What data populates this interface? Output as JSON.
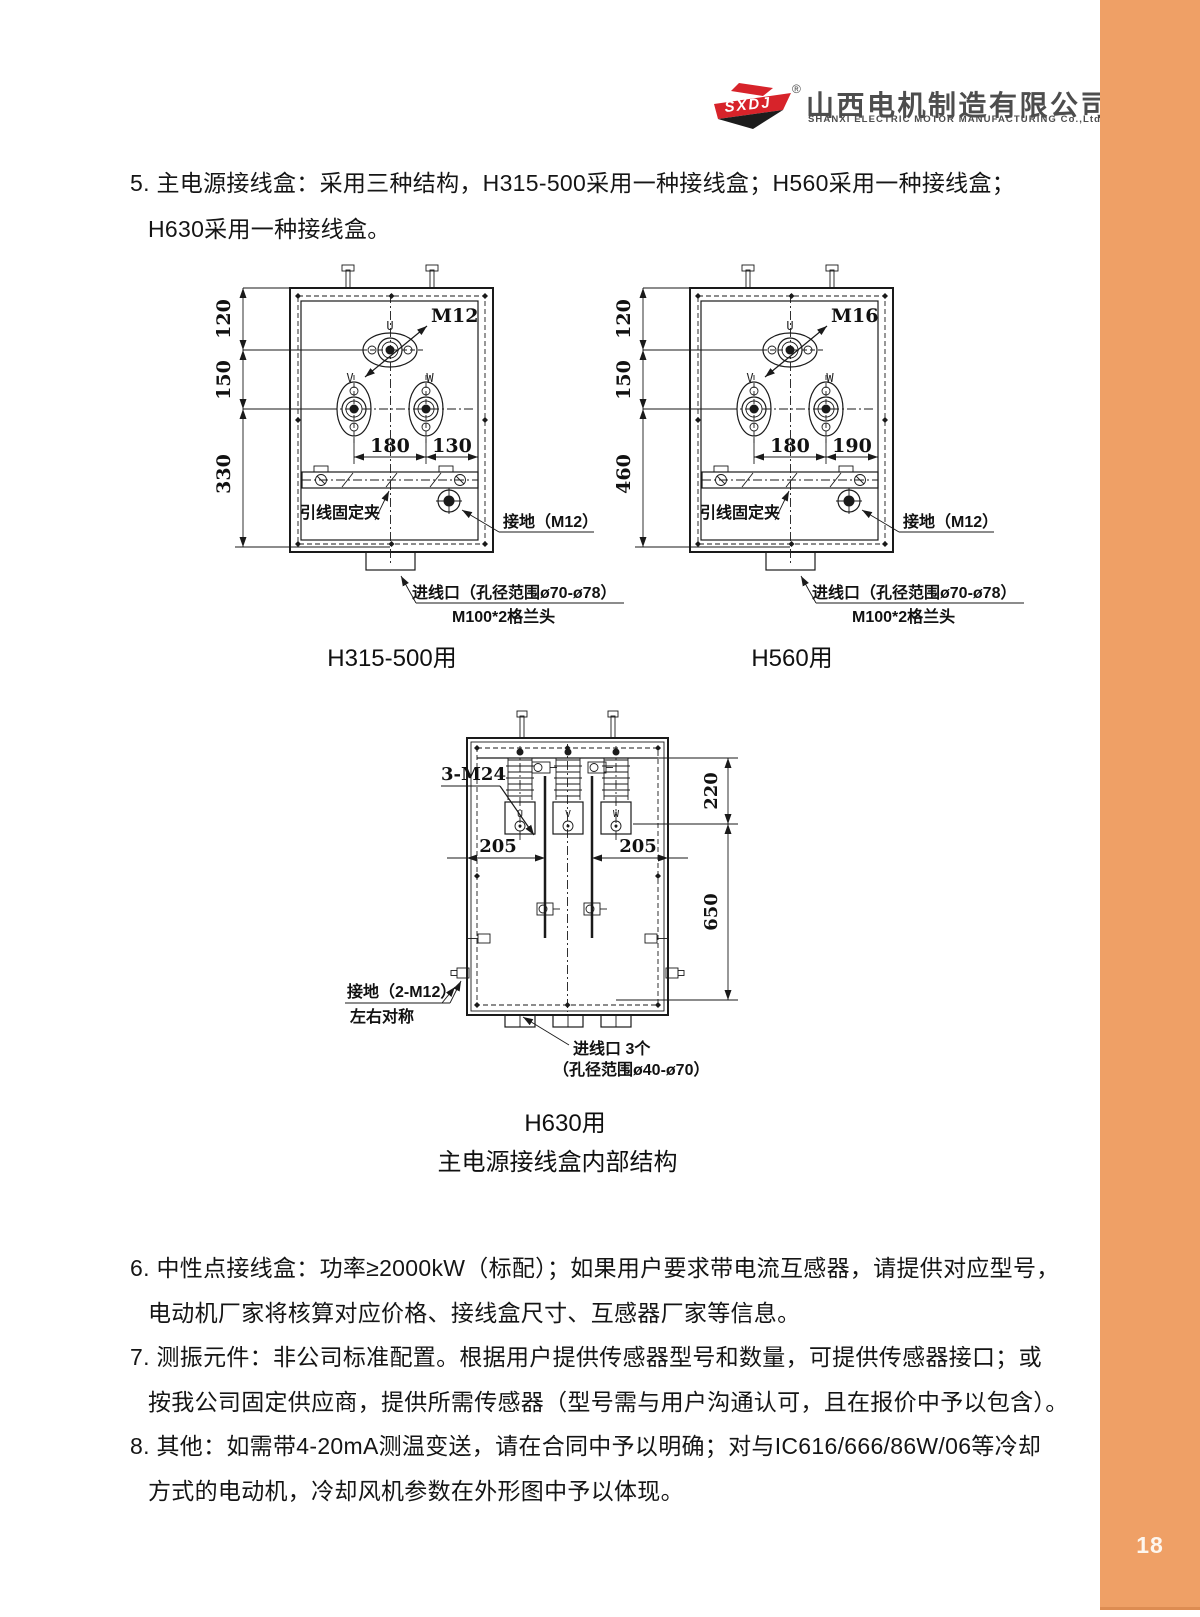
{
  "page": {
    "number": "18",
    "accent_color": "#efa066"
  },
  "header": {
    "logo": {
      "brand": "SXDJ",
      "registered": "®",
      "company_cn": "山西电机制造有限公司",
      "company_en": "SHANXI ELECTRIC MOTOR MANUFACTURING Co.,Ltd."
    }
  },
  "notes": {
    "item5_line1": "5. 主电源接线盒：采用三种结构，H315-500采用一种接线盒；H560采用一种接线盒；",
    "item5_line2": "H630采用一种接线盒。",
    "item6_line1": "6. 中性点接线盒：功率≥2000kW（标配）；如果用户要求带电流互感器，请提供对应型号，",
    "item6_line2": "电动机厂家将核算对应价格、接线盒尺寸、互感器厂家等信息。",
    "item7_line1": "7. 测振元件：非公司标准配置。根据用户提供传感器型号和数量，可提供传感器接口；或",
    "item7_line2": "按我公司固定供应商，提供所需传感器（型号需与用户沟通认可，且在报价中予以包含）。",
    "item8_line1": "8. 其他：如需带4-20mA测温变送，请在合同中予以明确；对与IC616/666/86W/06等冷却",
    "item8_line2": "方式的电动机，冷却风机参数在外形图中予以体现。"
  },
  "figures": {
    "group_caption": "主电源接线盒内部结构",
    "boxA": {
      "caption": "H315-500用",
      "terminal_thread": "M12",
      "terminals": [
        "U",
        "V",
        "W"
      ],
      "dims": {
        "top": "120",
        "mid": "150",
        "bottom": "330",
        "span_left": "180",
        "span_right": "130"
      },
      "labels": {
        "clamp": "引线固定夹",
        "ground": "接地（M12）",
        "inlet": "进线口（孔径范围ø70-ø78）",
        "gland": "M100*2格兰头"
      }
    },
    "boxB": {
      "caption": "H560用",
      "terminal_thread": "M16",
      "terminals": [
        "U",
        "V",
        "W"
      ],
      "dims": {
        "top": "120",
        "mid": "150",
        "bottom": "460",
        "span_left": "180",
        "span_right": "190"
      },
      "labels": {
        "clamp": "引线固定夹",
        "ground": "接地（M12）",
        "inlet": "进线口（孔径范围ø70-ø78）",
        "gland": "M100*2格兰头"
      }
    },
    "boxC": {
      "caption": "H630用",
      "stud_label": "3-M24",
      "terminals": [
        "U",
        "V",
        "W"
      ],
      "dims": {
        "left": "205",
        "right": "205",
        "top": "220",
        "height": "650"
      },
      "labels": {
        "ground_line1": "接地（2-M12）",
        "ground_line2": "左右对称",
        "inlet_line1": "进线口 3个",
        "inlet_line2": "（孔径范围ø40-ø70）"
      }
    }
  }
}
